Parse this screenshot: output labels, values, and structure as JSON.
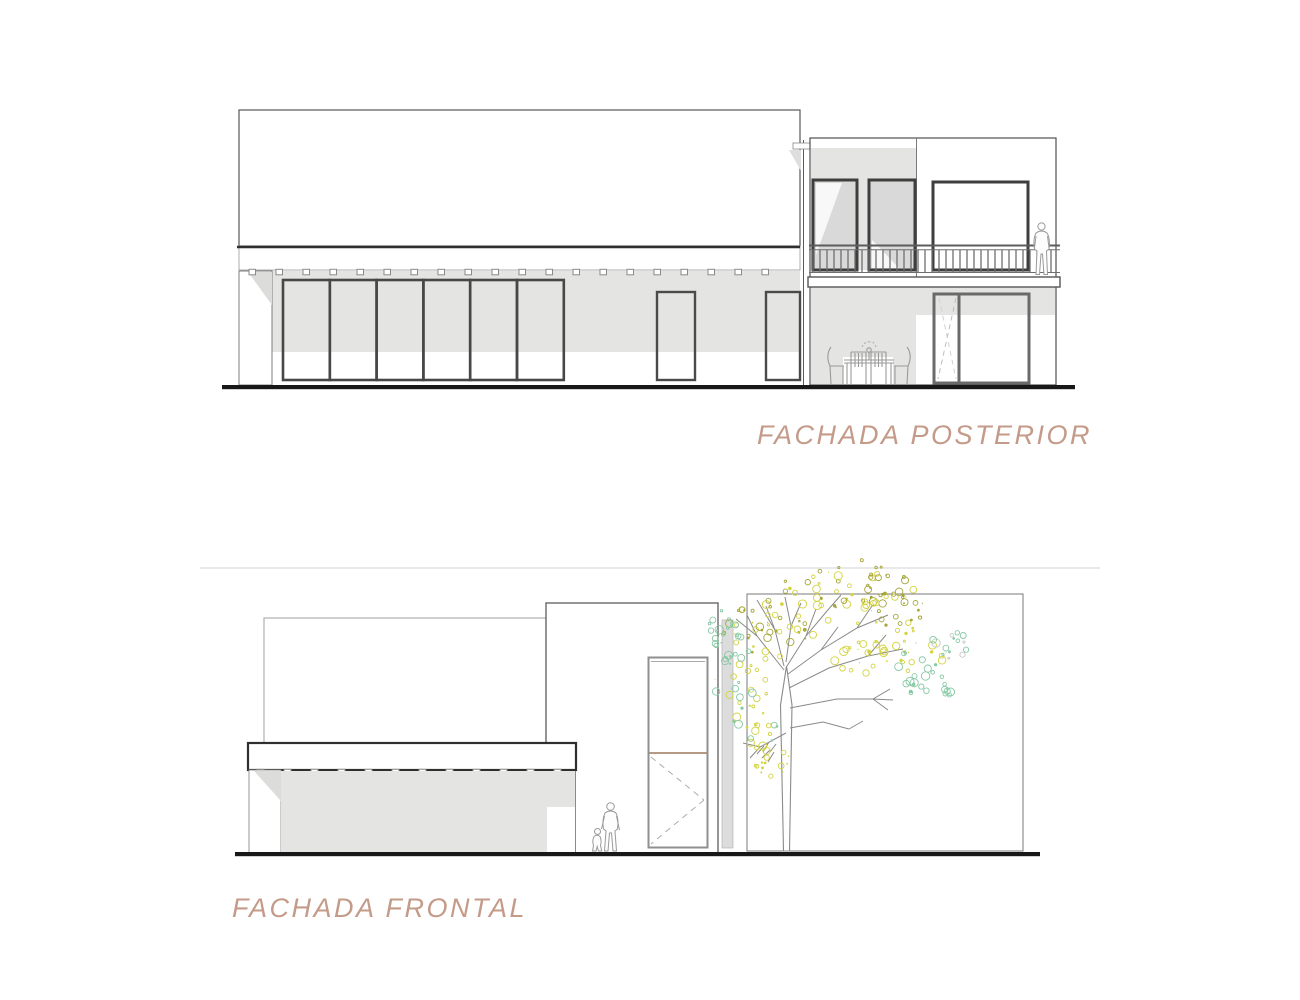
{
  "document": {
    "background": "#ffffff"
  },
  "titles": {
    "posterior": "FACHADA POSTERIOR",
    "frontal": "FACHADA FRONTAL"
  },
  "colors": {
    "title_text": "#c49a89",
    "wall_shade_gray": "#e4e4e3",
    "glass_gray": "#d9d9d9",
    "frame_dark": "#3e3e3e",
    "ground_line": "#181818",
    "door_divider_brown": "#a98b72",
    "foliage_yellow": "#d3d341",
    "foliage_olive": "#a6a63a",
    "foliage_green": "#86c9a4",
    "foliage_gray": "#c6c9c2"
  }
}
